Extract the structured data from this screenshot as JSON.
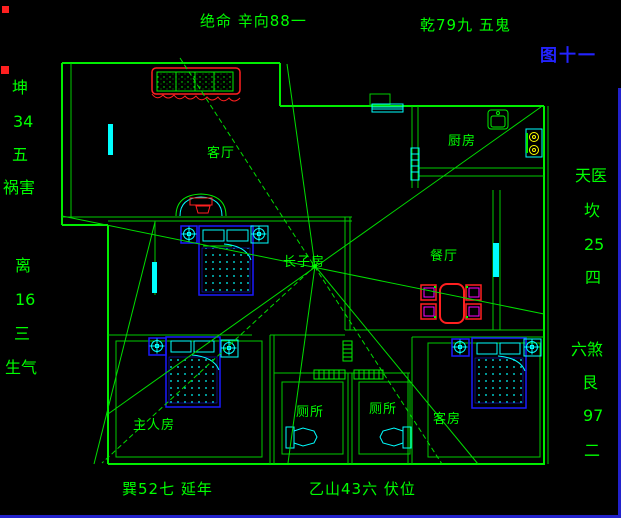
{
  "figure": {
    "label": "图十一"
  },
  "labels": {
    "jueming": "绝命 辛向88一",
    "wugui": "乾79九 五鬼",
    "kun": "坤",
    "kun_num": "34",
    "kun_five": "五",
    "huohai": "祸害",
    "li": "离",
    "li_num": "16",
    "li_three": "三",
    "shengqi": "生气",
    "tianyi": "天医",
    "kan": "坎",
    "kan_num": "25",
    "kan_four": "四",
    "liusha": "六煞",
    "gen": "艮",
    "gen_num": "97",
    "gen_two": "二",
    "yannian": "巽52七 延年",
    "fuwei": "乙山43六 伏位"
  },
  "rooms": {
    "living": "客厅",
    "kitchen": "厨房",
    "dining": "餐厅",
    "eldest": "长子房",
    "master": "主人房",
    "toilet_left": "厕所",
    "toilet_right": "厕所",
    "guest": "客房"
  },
  "colors": {
    "background": "#000000",
    "wall_green": "#00ee00",
    "text_green": "#00ff00",
    "window_cyan": "#00ffff",
    "furniture_blue": "#1a1aff",
    "accent_red": "#ff2020",
    "accent_magenta": "#ff00ff",
    "burner_yellow": "#ffff00",
    "figure_blue": "#2323ff",
    "frame_blue": "#2222cc"
  }
}
